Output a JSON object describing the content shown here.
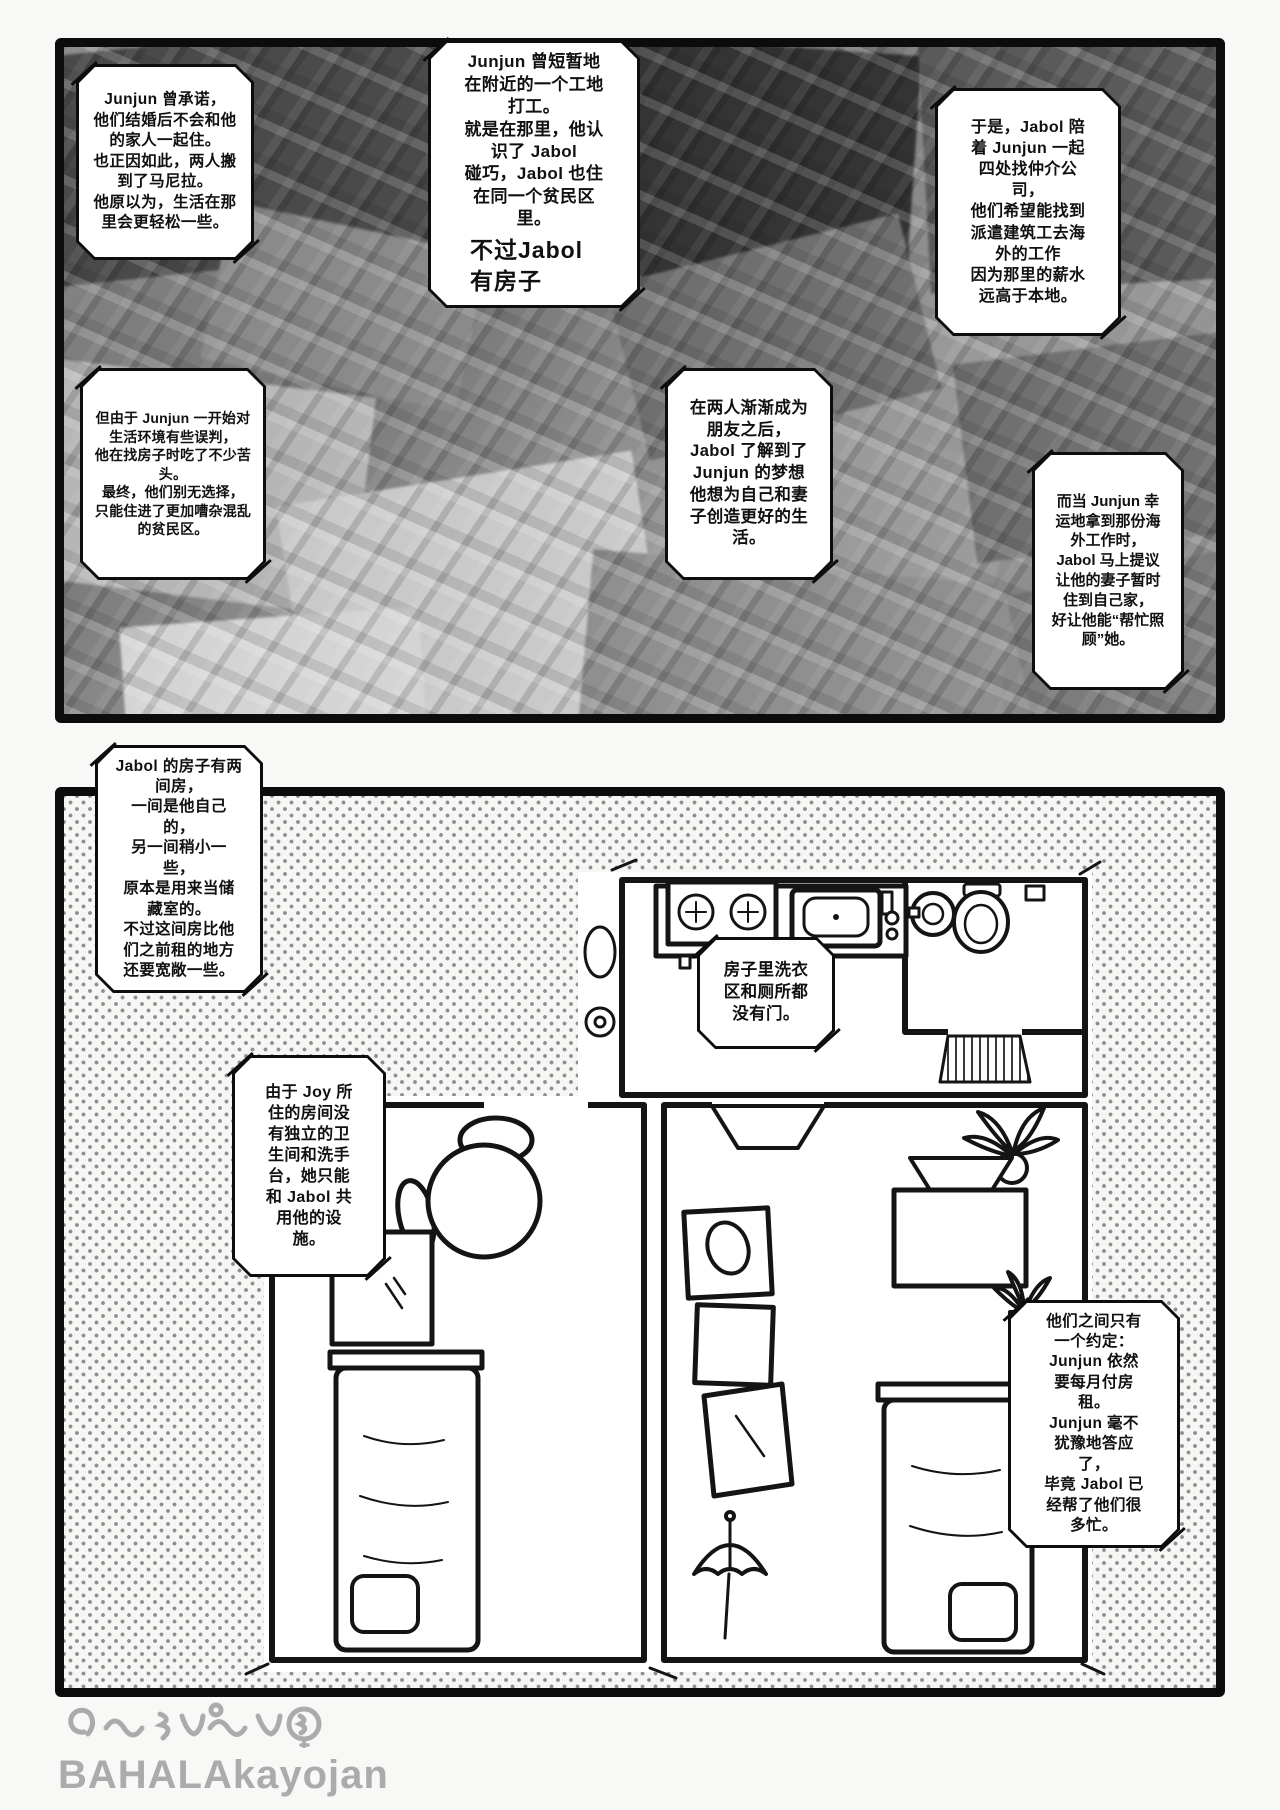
{
  "panel1": {
    "b1": {
      "text": "Junjun 曾承诺，\n他们结婚后不会和他\n的家人一起住。\n也正因如此，两人搬\n到了马尼拉。\n他原以为，生活在那\n里会更轻松一些。"
    },
    "b2": {
      "text": "Junjun 曾短暂地\n在附近的一个工地\n打工。\n就是在那里，他认\n识了 Jabol\n碰巧，Jabol 也住\n在同一个贫民区\n里。",
      "emphasis": "不过Jabol\n有房子"
    },
    "b3": {
      "text": "于是，Jabol 陪\n着 Junjun 一起\n四处找仲介公\n司，\n他们希望能找到\n派遣建筑工去海\n外的工作\n因为那里的薪水\n远高于本地。"
    },
    "b4": {
      "text": "但由于 Junjun 一开始对\n生活环境有些误判，\n他在找房子时吃了不少苦\n头。\n最终，他们别无选择，\n只能住进了更加嘈杂混乱\n的贫民区。"
    },
    "b5": {
      "text": "在两人渐渐成为\n朋友之后，\nJabol 了解到了\nJunjun 的梦想\n他想为自己和妻\n子创造更好的生\n活。"
    },
    "b6": {
      "text": "而当 Junjun 幸\n运地拿到那份海\n外工作时，\nJabol 马上提议\n让他的妻子暂时\n住到自己家，\n好让他能“帮忙照\n顾”她。"
    }
  },
  "panel2": {
    "b7": {
      "text": "Jabol 的房子有两\n间房，\n一间是他自己\n的，\n另一间稍小一\n些，\n原本是用来当储\n藏室的。\n不过这间房比他\n们之前租的地方\n还要宽敞一些。"
    },
    "b8": {
      "text": "房子里洗衣\n区和厕所都\n没有门。"
    },
    "b9": {
      "text": "由于 Joy 所\n住的房间没\n有独立的卫\n生间和洗手\n台，她只能\n和 Jabol 共\n用他的设\n施。"
    },
    "b10": {
      "text": "他们之间只有\n一个约定：\nJunjun 依然\n要每月付房\n租。\nJunjun 毫不\n犹豫地答应\n了，\n毕竟 Jabol 已\n经帮了他们很\n多忙。"
    }
  },
  "watermark": {
    "text": "BAHALAkayojan"
  }
}
